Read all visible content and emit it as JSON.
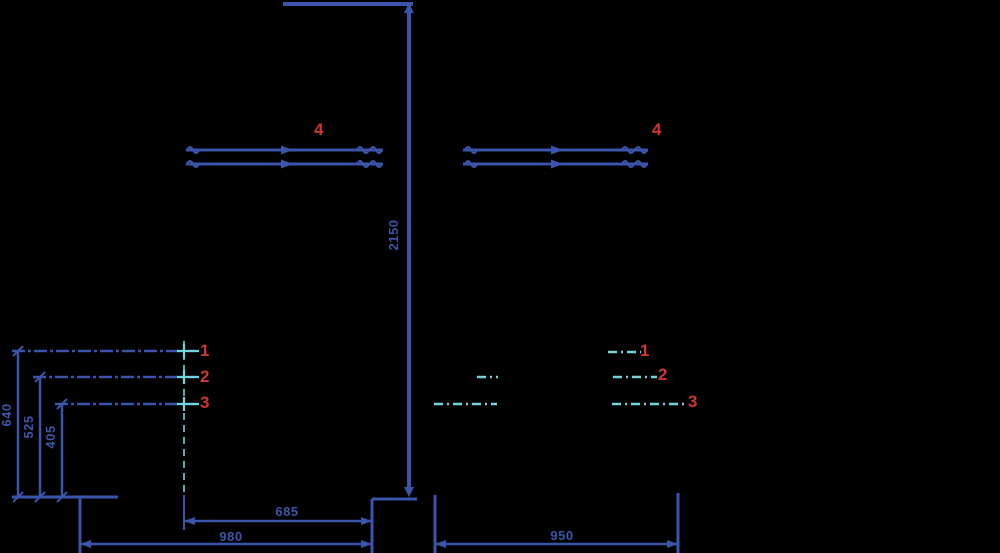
{
  "colors": {
    "background": "#000000",
    "line_blue": "#3b55aa",
    "accent_cyan": "#72d5da",
    "label_red": "#d13434"
  },
  "callouts": {
    "left": {
      "c1": "1",
      "c2": "2",
      "c3": "3",
      "c4": "4"
    },
    "right": {
      "c1": "1",
      "c2": "2",
      "c3": "3",
      "c4": "4"
    }
  },
  "dimensions": {
    "pole_height": "2150",
    "left_heights": [
      "640",
      "525",
      "405"
    ],
    "bottom_inner_left": "685",
    "bottom_outer_left": "980",
    "bottom_right": "950"
  }
}
